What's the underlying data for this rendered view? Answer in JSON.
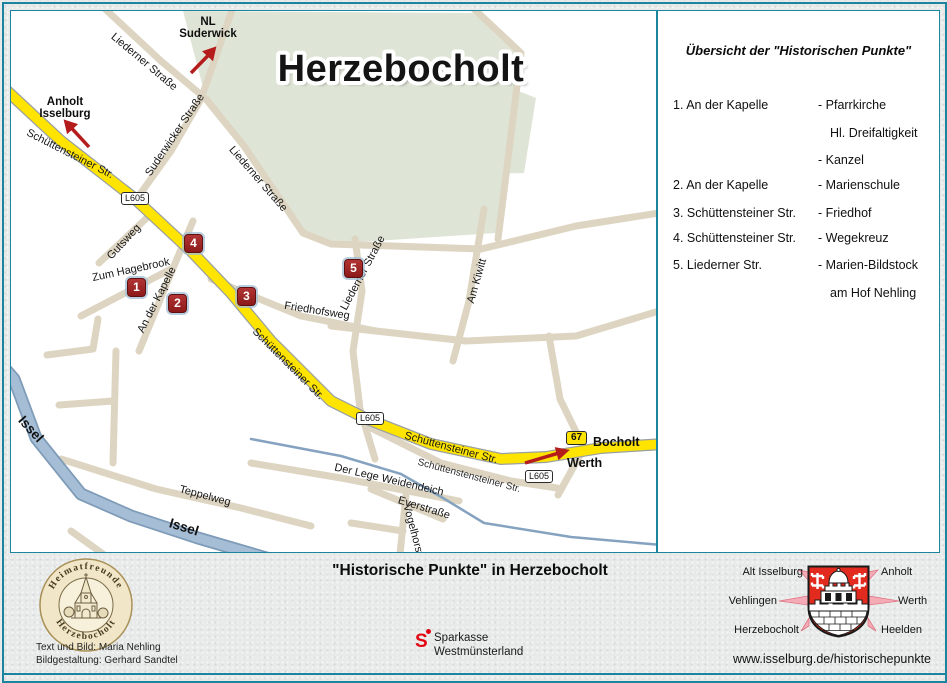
{
  "map": {
    "title": "Herzebocholt",
    "badge_l605": "L605",
    "badge_b67": "67",
    "markers": [
      "1",
      "2",
      "3",
      "4",
      "5"
    ],
    "destinations": {
      "suderwick_line1": "NL",
      "suderwick_line2": "Suderwick",
      "anholt_line1": "Anholt",
      "anholt_line2": "Isselburg",
      "bocholt": "Bocholt",
      "werth": "Werth"
    },
    "road_labels": [
      "Schüttensteiner Str.",
      "Suderwicker Straße",
      "Liederner Straße",
      "Liederner Straße",
      "Liederner Straße",
      "Gutsweg",
      "Zum Hagebrook",
      "An der Kapelle",
      "Friedhofsweg",
      "Am Kiwitt",
      "Schüttensteiner Str.",
      "Schüttensteiner Str.",
      "Schüttenstensteiner Str.",
      "Der Lege Weidendeich",
      "Teppelweg",
      "Everstraße",
      "Vogelhorst"
    ],
    "water_labels": [
      "Issel",
      "Issel"
    ]
  },
  "legend": {
    "title": "Übersicht der \"Historischen Punkte\"",
    "rows": [
      {
        "place": "1. An der Kapelle",
        "desc": "- Pfarrkirche"
      },
      {
        "place": "",
        "desc": "Hl. Dreifaltigkeit"
      },
      {
        "place": "",
        "desc": "- Kanzel"
      },
      {
        "place": "2. An der Kapelle",
        "desc": "- Marienschule"
      },
      {
        "place": "3. Schüttensteiner Str.",
        "desc": "- Friedhof"
      },
      {
        "place": "4. Schüttensteiner Str.",
        "desc": "- Wegekreuz"
      },
      {
        "place": "5. Liederner Str.",
        "desc": "- Marien-Bildstock"
      },
      {
        "place": "",
        "desc": "am Hof Nehling"
      }
    ]
  },
  "footer": {
    "seal_top": "Heimatfreunde",
    "seal_bottom": "Herzebocholt",
    "credits_line1": "Text und Bild: Maria Nehling",
    "credits_line2": "Bildgestaltung: Gerhard Sandtel",
    "title": "\"Historische Punkte\" in Herzebocholt",
    "sponsor_initial": "S",
    "sponsor_line1": "Sparkasse",
    "sponsor_line2": "Westmünsterland",
    "crest_labels": {
      "left": [
        "Alt Isselburg",
        "Vehlingen",
        "Herzebocholt"
      ],
      "right": [
        "Anholt",
        "Werth",
        "Heelden"
      ]
    },
    "url": "www.isselburg.de/historischepunkte"
  },
  "colors": {
    "frame_teal": "#1b85a0",
    "road_yellow": "#ffe400",
    "road_beige": "#ddd5c1",
    "area_green": "#dfe5d6",
    "water_blue": "#9db7d2",
    "marker_red": "#9e2020",
    "arrow_red": "#b51d1d",
    "sparkasse_red": "#e30613",
    "crest_red": "#e32a1e"
  }
}
